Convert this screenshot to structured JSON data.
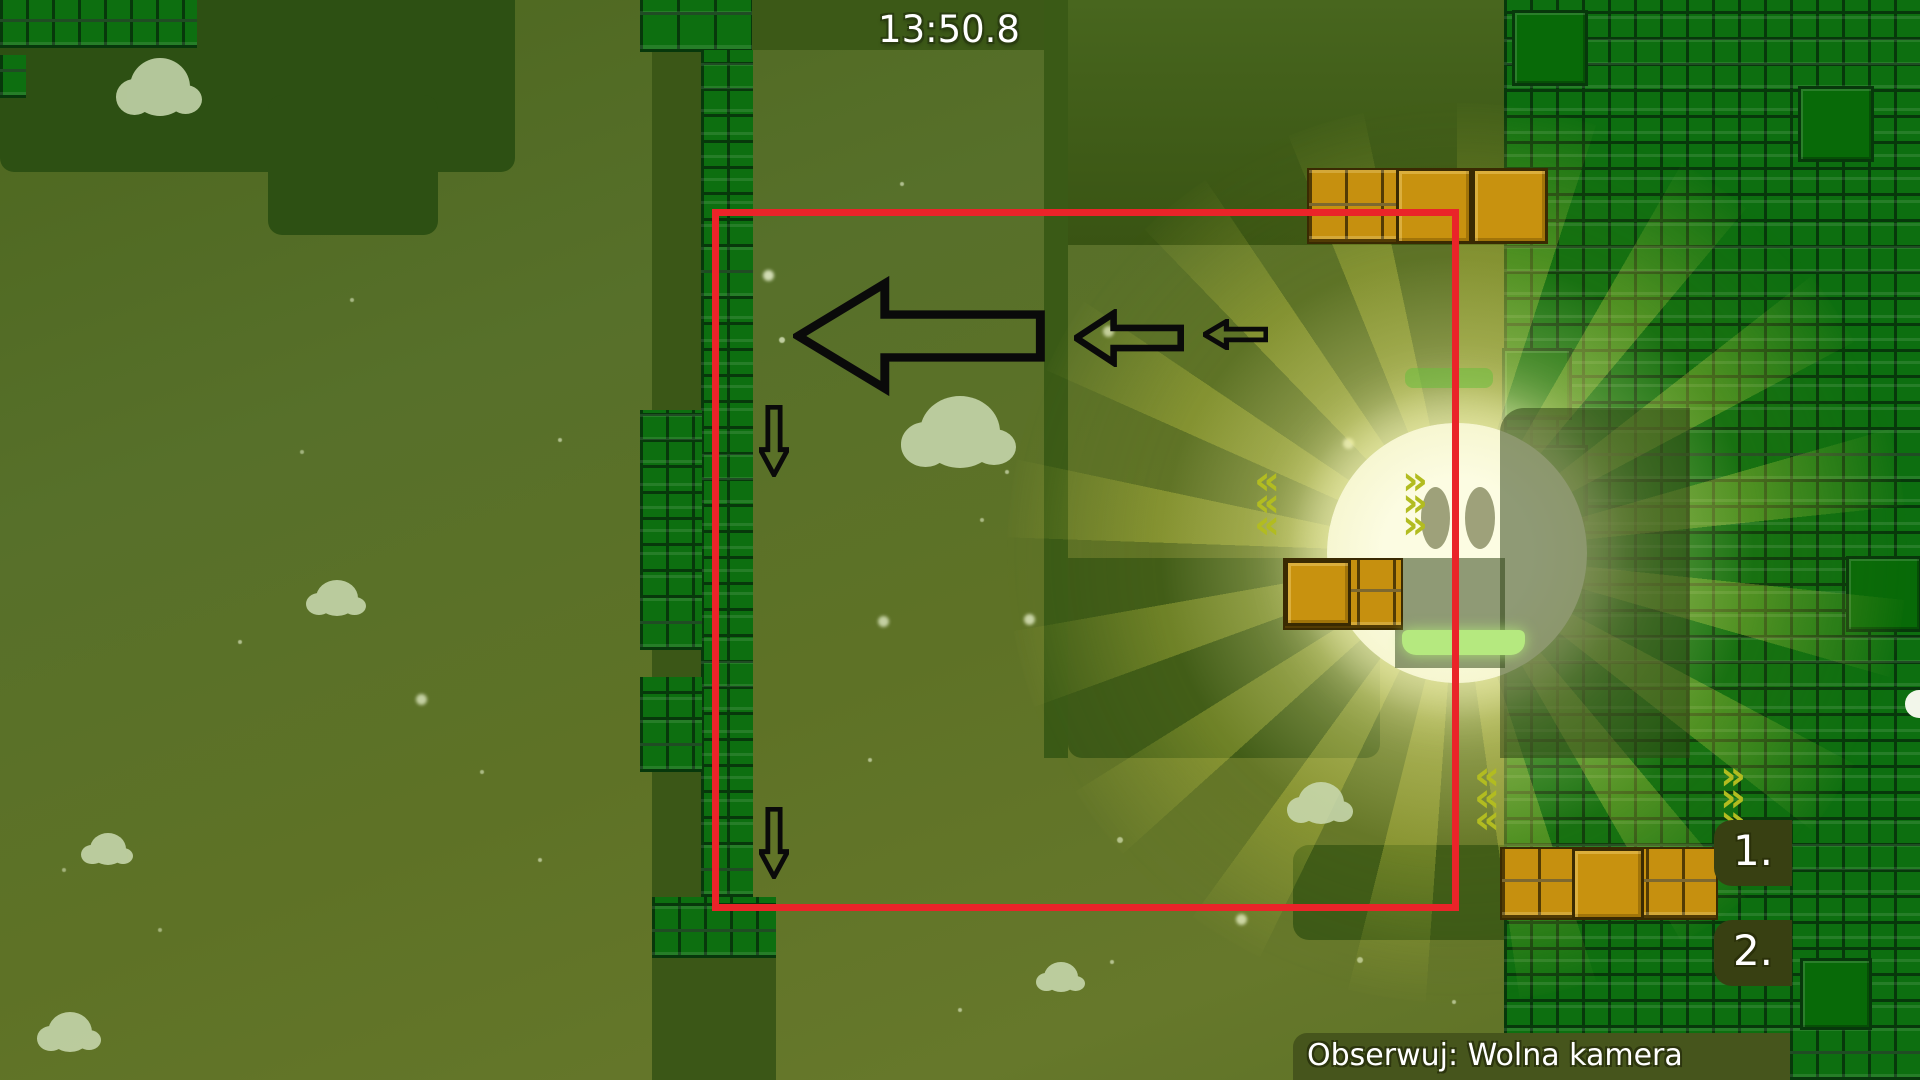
{
  "hud": {
    "timer": "13:50.8",
    "spectate_text": "Obserwuj: Wolna kamera",
    "ranks": [
      {
        "label": "1."
      },
      {
        "label": "2."
      }
    ]
  },
  "world": {
    "chevron_left": "«",
    "chevron_right": "»",
    "entities": {
      "sun_character": "glowing-sun-ball-with-eyes",
      "platforms": [
        "green-jelly-platform-top",
        "green-jelly-platform-bottom"
      ],
      "gold_clusters": [
        "top-right",
        "middle-right",
        "bottom-right"
      ],
      "white_ball_edge": "partially-visible-at-right-edge"
    },
    "annotations": {
      "camera_rect": "red-selection-rectangle",
      "arrows": [
        "large-left-arrow",
        "medium-left-arrow",
        "small-left-arrow",
        "down-arrow-upper",
        "down-arrow-lower"
      ]
    }
  },
  "colors": {
    "background_olive": "#5e7226",
    "terrain_dark": "#2d5013",
    "terrain_medium_dark": "#3c5917",
    "block_green": "#0d6f10",
    "block_gap": "#07380b",
    "gold_block": "#c6900f",
    "sun_core": "#f1f1c0",
    "ray_yellow": "#d2d246",
    "platform_green": "#b5e97f",
    "chevron_yellow": "#b2bc20",
    "camera_rect_red": "#ea2429",
    "hud_bar": "#46551c",
    "hud_text": "#ffffff",
    "annotation_black": "#0a0a0a",
    "cloud": "#cbdbb2"
  }
}
